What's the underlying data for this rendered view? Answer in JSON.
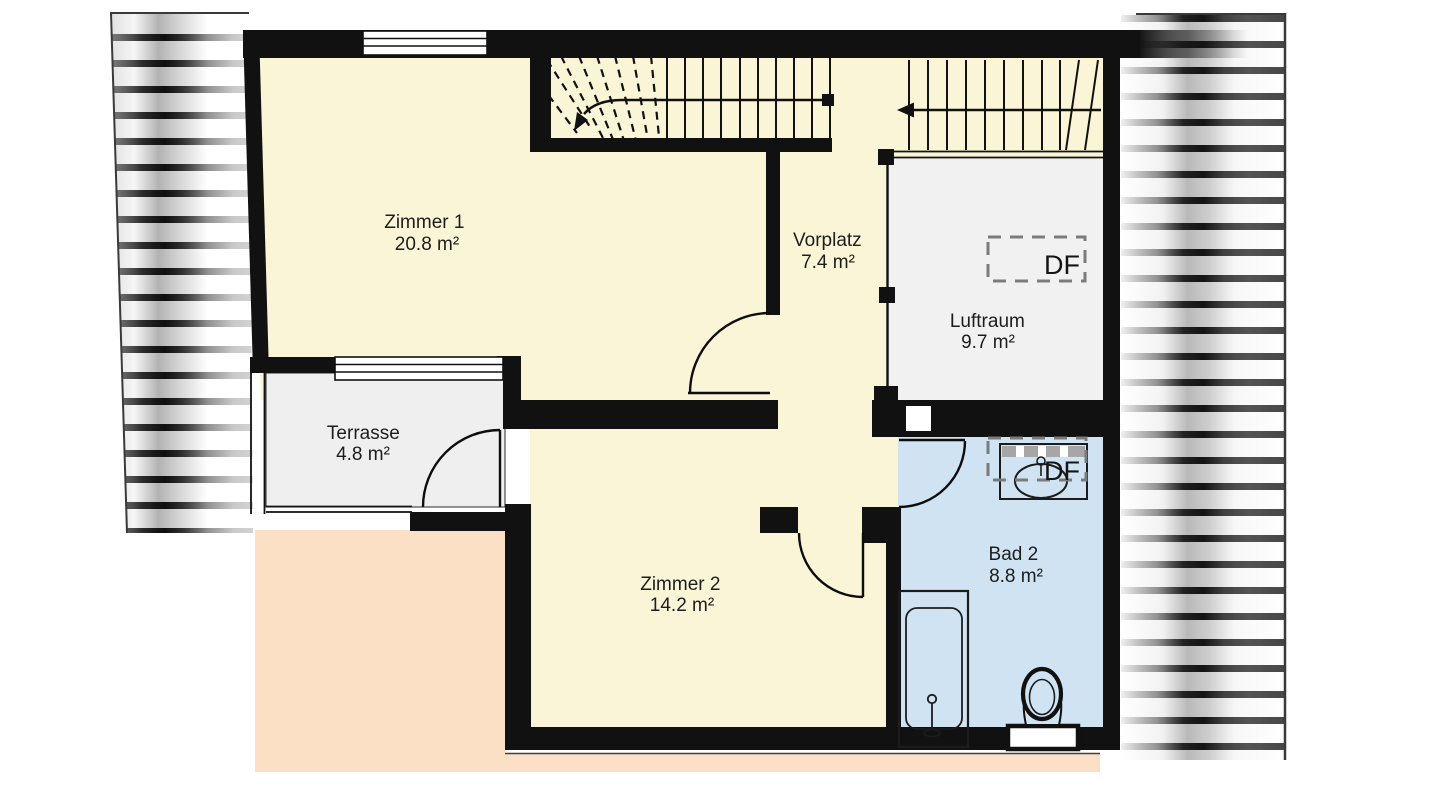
{
  "plan": {
    "rooms": [
      {
        "id": "zimmer1",
        "name": "Zimmer 1",
        "area": "20.8 m²"
      },
      {
        "id": "vorplatz",
        "name": "Vorplatz",
        "area": "7.4 m²"
      },
      {
        "id": "luftraum",
        "name": "Luftraum",
        "area": "9.7 m²"
      },
      {
        "id": "terrasse",
        "name": "Terrasse",
        "area": "4.8 m²"
      },
      {
        "id": "zimmer2",
        "name": "Zimmer 2",
        "area": "14.2 m²"
      },
      {
        "id": "bad2",
        "name": "Bad 2",
        "area": "8.8 m²"
      }
    ],
    "roof_windows": [
      {
        "label": "DF"
      },
      {
        "label": "DF"
      }
    ],
    "colors": {
      "room_floor": "#FAF5D6",
      "terrace_floor": "#EFEFEF",
      "void_floor": "#F1F1F1",
      "bath_floor": "#CFE3F2",
      "lower_roof": "#FBE0C5",
      "wall": "#111111",
      "label_text": "#1d1d1d",
      "df_dash": "#7B7B7B"
    }
  }
}
